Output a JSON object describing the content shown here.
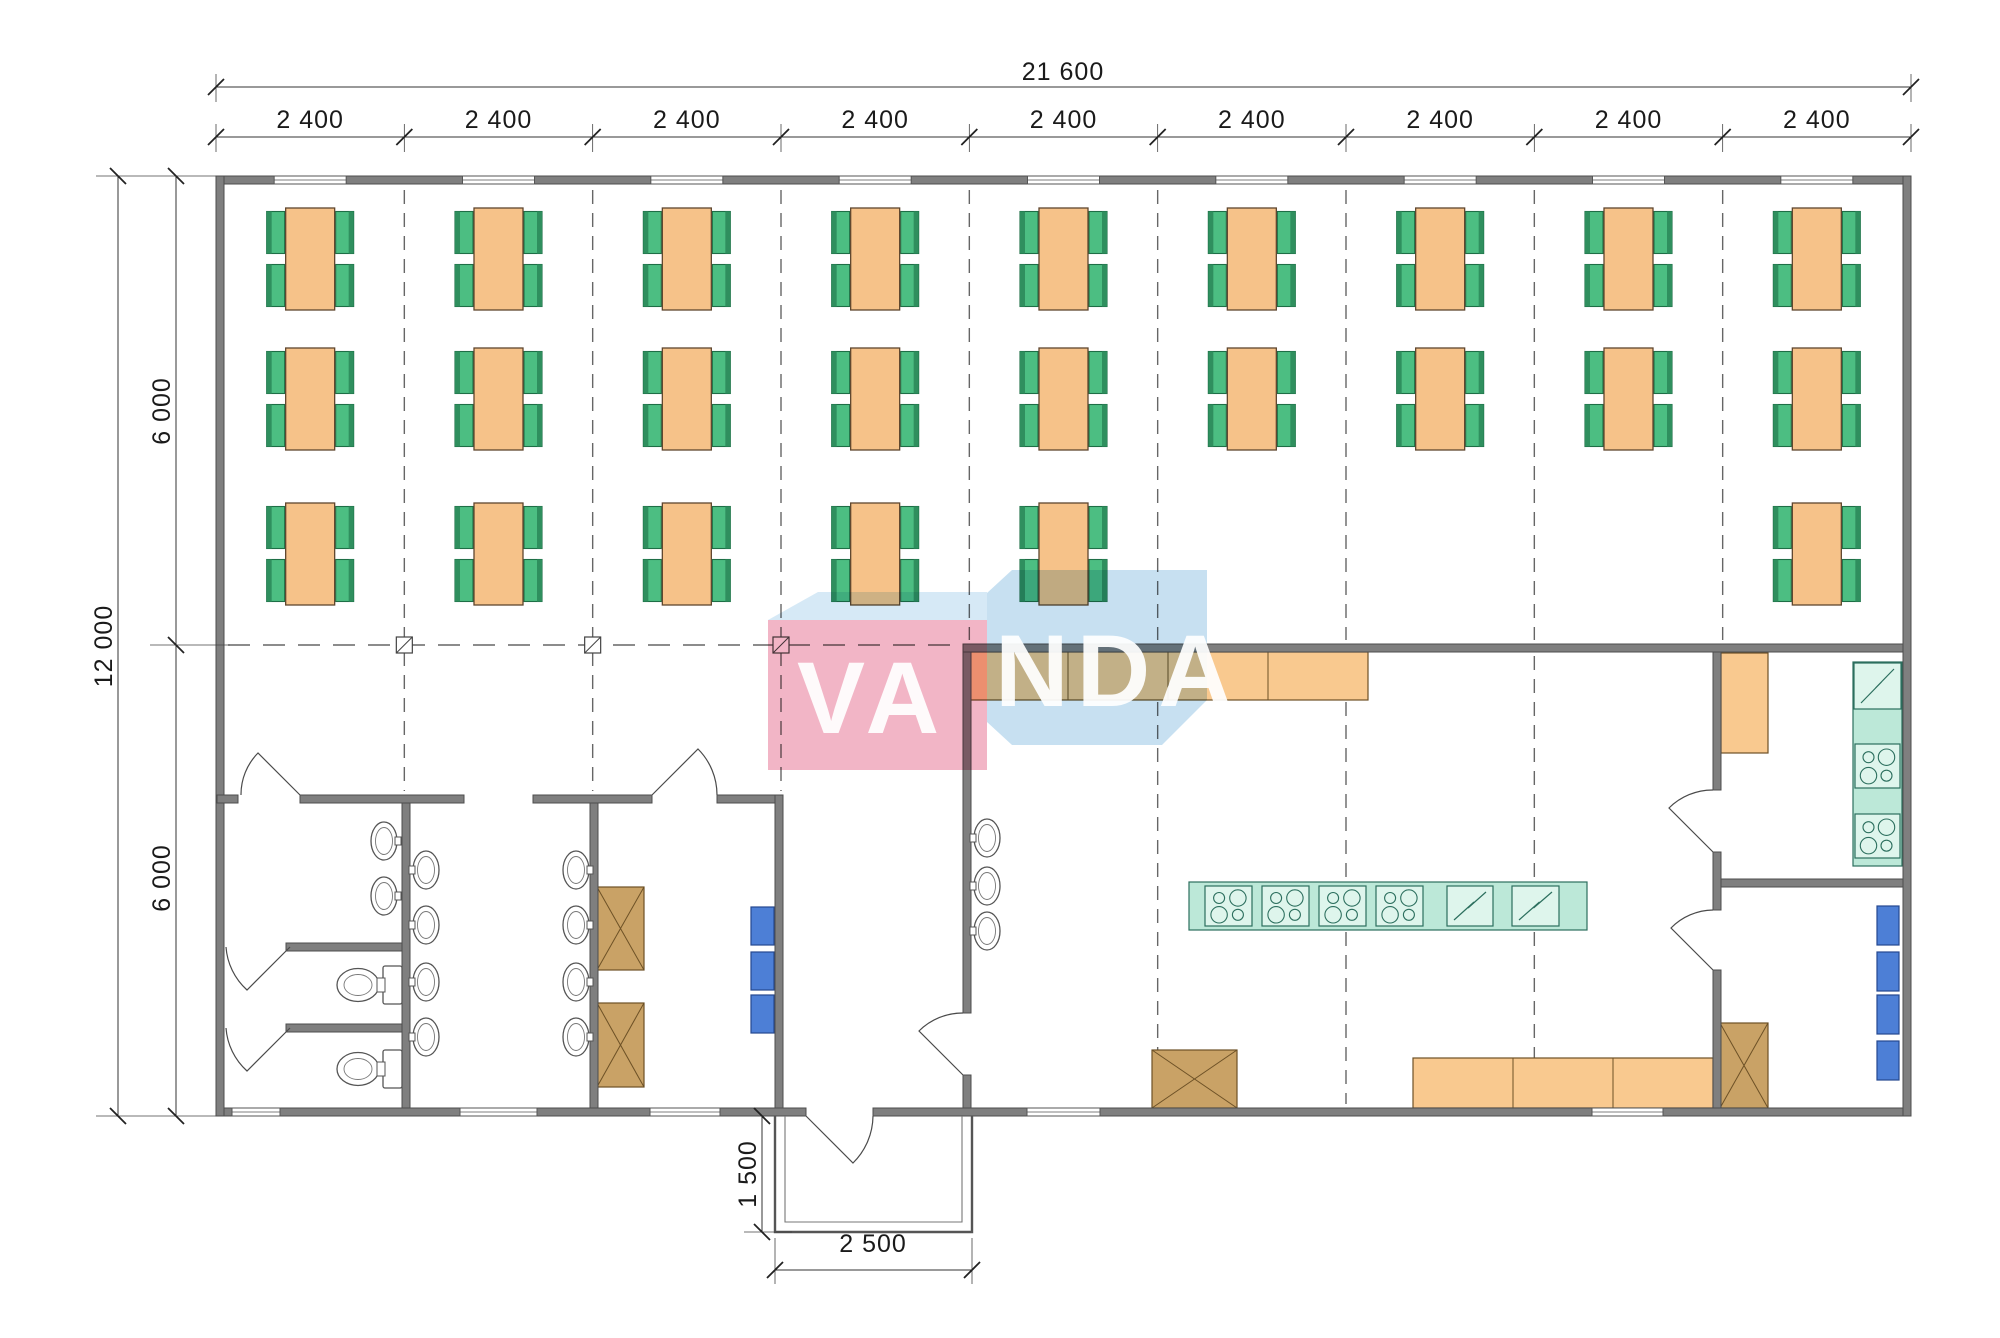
{
  "title": "Canteen module floor plan 12000 x 21600",
  "dimensions": {
    "total_width": "21 600",
    "bays": [
      "2 400",
      "2 400",
      "2 400",
      "2 400",
      "2 400",
      "2 400",
      "2 400",
      "2 400",
      "2 400"
    ],
    "total_depth": "12 000",
    "depth_upper": "6 000",
    "depth_lower": "6 000",
    "porch_depth": "1 500",
    "porch_width": "2 500"
  },
  "watermark": {
    "text": "VANDA",
    "part_left": "VA",
    "part_right": "NDA"
  },
  "colors": {
    "wall": "#7f7f7f",
    "wall_edge": "#4d4d4d",
    "table_orange": "#f6c289",
    "chair_green": "#4cbe82",
    "chair_green_dark": "#2f8f5e",
    "counter_orange": "#f9c98f",
    "counter_teal": "#bce8d8",
    "stove_teal_light": "#def5ec",
    "teal_edge": "#2c6f5e",
    "cabinet_tan": "#c9a266",
    "cabinet_tan_edge": "#6d5126",
    "locker_blue": "#4d7fd6",
    "locker_blue_edge": "#25488f",
    "watermark_pink": "#efa3b8",
    "watermark_blue": "#b9d9ee",
    "watermark_bevel": "#cfe6f5",
    "dimension_text": "#1a1a1a",
    "grid_line": "#666666"
  },
  "dining": {
    "rows": 3,
    "columns": 9,
    "chairs_per_table": 4,
    "table_cells": [
      [
        1,
        1
      ],
      [
        2,
        1
      ],
      [
        3,
        1
      ],
      [
        4,
        1
      ],
      [
        5,
        1
      ],
      [
        6,
        1
      ],
      [
        7,
        1
      ],
      [
        8,
        1
      ],
      [
        9,
        1
      ],
      [
        1,
        2
      ],
      [
        2,
        2
      ],
      [
        3,
        2
      ],
      [
        4,
        2
      ],
      [
        5,
        2
      ],
      [
        6,
        2
      ],
      [
        7,
        2
      ],
      [
        8,
        2
      ],
      [
        9,
        2
      ],
      [
        1,
        3
      ],
      [
        2,
        3
      ],
      [
        3,
        3
      ],
      [
        4,
        3
      ],
      [
        5,
        3
      ],
      [
        9,
        3
      ]
    ]
  },
  "fixtures": {
    "toilets": 2,
    "wash_basins": 13,
    "stove_tops": 6,
    "electric_appliances": 3,
    "lockers_blue": 7,
    "cabinets_tan": 4,
    "counter_sections_orange": 8,
    "windows_top": 9,
    "windows_bottom": 5,
    "doors": 8,
    "column_markers": 3
  }
}
